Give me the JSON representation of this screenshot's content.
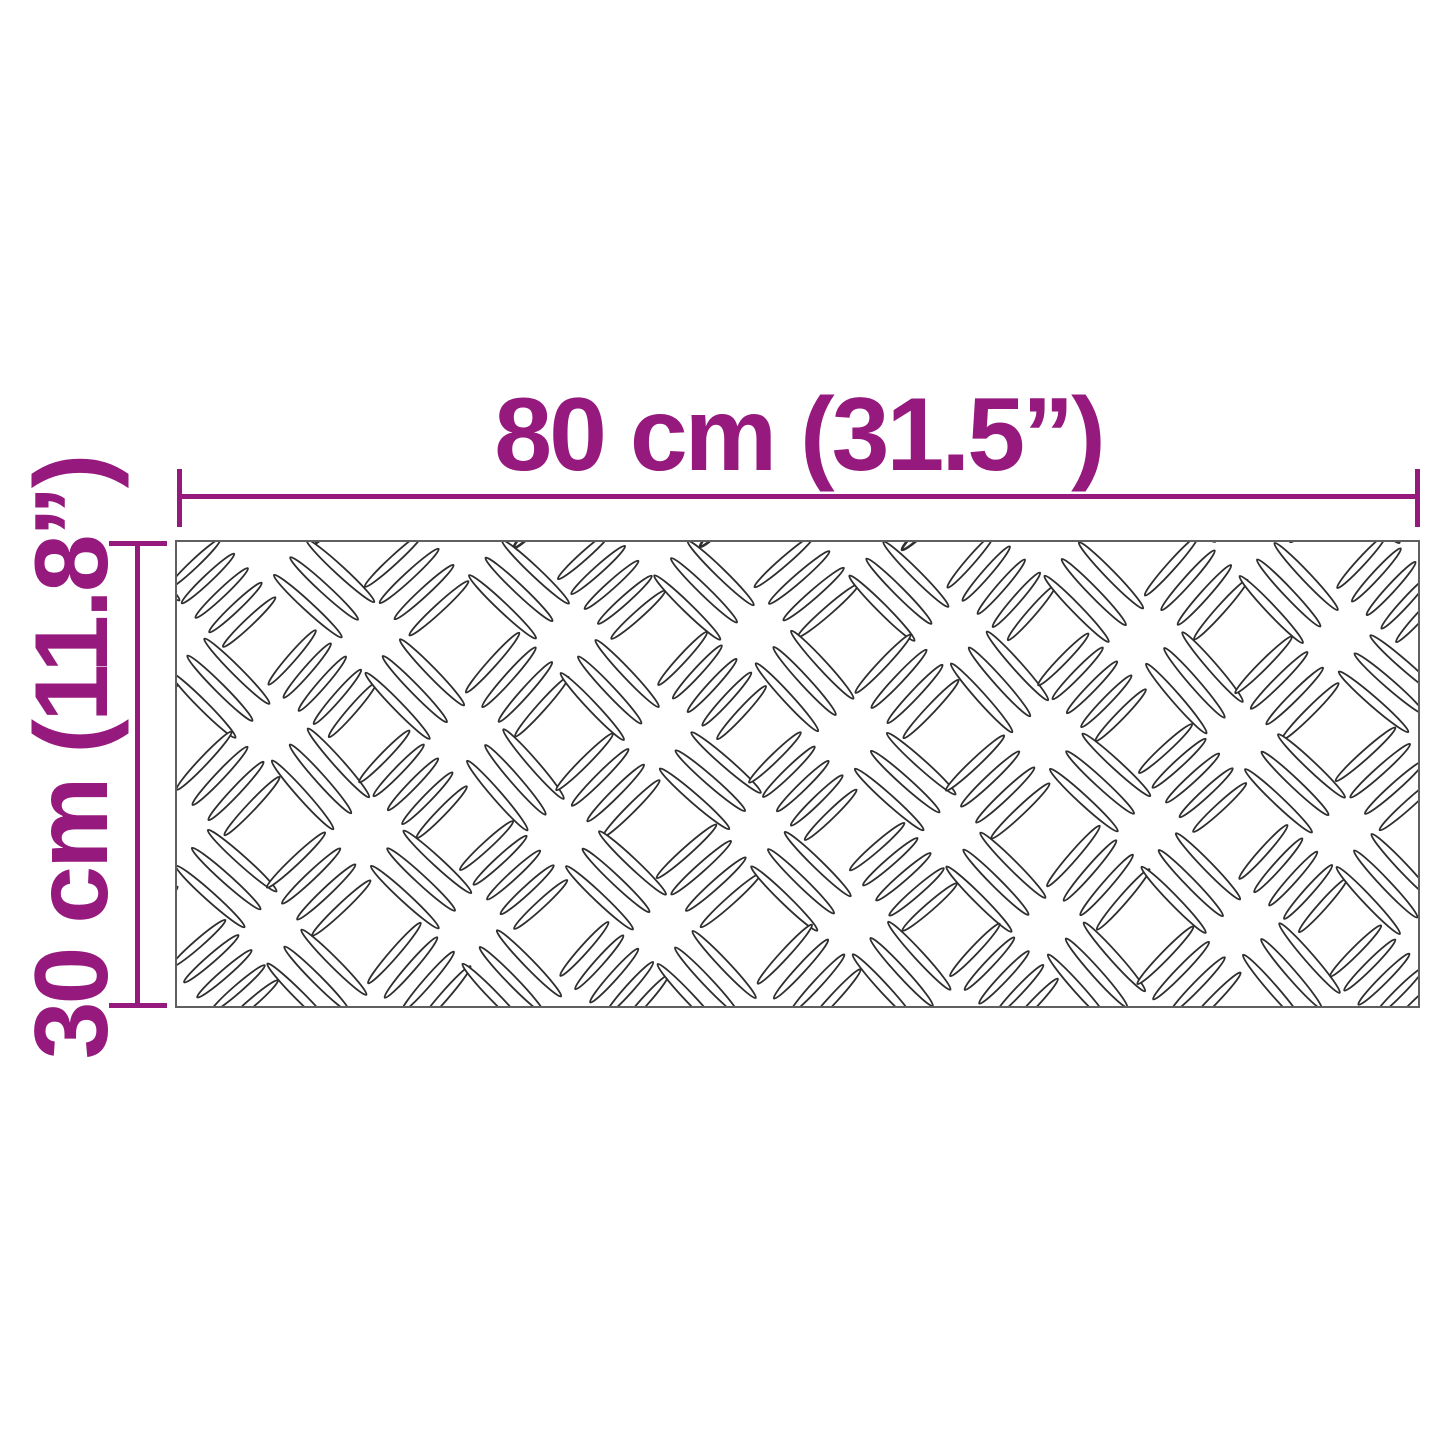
{
  "diagram": {
    "description": "product dimension diagram of a rectangular aluminium checker plate sheet",
    "width_label": "80 cm (31.5”)",
    "height_label": "30 cm (11.8”)",
    "width_value": "80 cm",
    "width_inches": "31.5”",
    "height_value": "30 cm",
    "height_inches": "11.8”"
  },
  "colors": {
    "dimension_accent": "#96197E",
    "plate_border": "#5f5f5f",
    "grain_line": "#2e2e2e",
    "background": "#ffffff"
  }
}
